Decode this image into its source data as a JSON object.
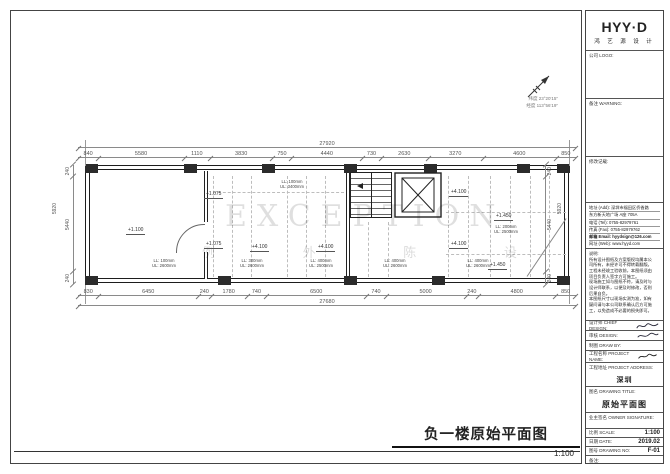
{
  "page": {
    "main_title": "负一楼原始平面图",
    "main_scale": "1:100"
  },
  "compass": {
    "line1": "纬度 23°20′15″",
    "line2": "经度 113°56′19″"
  },
  "watermark": {
    "en": "EXCEPTION",
    "cn": "例 外 陈 设"
  },
  "plan": {
    "levels": [
      {
        "text": "+1.100"
      },
      {
        "text": "+1.075"
      },
      {
        "text": "+1.075"
      },
      {
        "text": "+4.100"
      },
      {
        "text": "+4.100"
      },
      {
        "text": "+4.100"
      },
      {
        "text": "+1.450"
      },
      {
        "text": "+4.100"
      },
      {
        "text": "+1.450"
      }
    ],
    "beams": [
      {
        "l1": "LL: 100mm",
        "l2": "UL: 3400mm"
      },
      {
        "l1": "LL: 100mm",
        "l2": "UL: 2600mm"
      },
      {
        "l1": "LL: 300mm",
        "l2": "UL: 2600mm"
      },
      {
        "l1": "LL: 400mm",
        "l2": "UL: 2500mm"
      },
      {
        "l1": "LL: 400mm",
        "l2": "UL: 2600mm"
      },
      {
        "l1": "LL: 200mm",
        "l2": "UL: 2500mm"
      },
      {
        "l1": "LL: 400mm",
        "l2": "UL: 2600mm"
      }
    ],
    "dims": {
      "top_total": "27920",
      "top": [
        "840",
        "5580",
        "1110",
        "3830",
        "750",
        "4440",
        "730",
        "2630",
        "3270",
        "4600",
        "850"
      ],
      "bottom_total": "27680",
      "bottom": [
        "830",
        "6450",
        "240",
        "1780",
        "740",
        "6500",
        "740",
        "5000",
        "240",
        "4800",
        "850"
      ],
      "left_total": "5920",
      "left": [
        "240",
        "5440",
        "240"
      ],
      "right_total": "5920",
      "right": [
        "240",
        "5440",
        "240"
      ]
    }
  },
  "panel": {
    "logo": {
      "text": "HYY·D",
      "sub": "鸿 艺 源 设 计"
    },
    "company_logo_label": "公司 LOGO:",
    "warning_label": "备注 WARNING:",
    "revision_label": "修改记载:",
    "contact": {
      "addr1": "地址 (Add): 深圳市福田区侨香路",
      "addr2": "东方新天地广场 A座 705A",
      "tel": "电话 (Tel): 0755-82979761",
      "fax": "传真 (Fax): 0755-82979762",
      "email": "邮箱 Email: hyydsign@126.com",
      "web": "网址 (Web): www.hyyd.com"
    },
    "notes": "说明:\n所有设计图纸及方案版权均属本公\n司所有，未经许可不得转载翻版。\n工程未经竣工验收前，本图纸须由\n项目负责人签字方可施工。\n现场施工如与图纸不符，请及时与\n设计师联系，以便及时修改，否则\n后果自负。\n本图纸尺寸以现场实测为准，如有\n疑问请与本公司联系确认后方可施\n工，以免造成不必要的损失即可。",
    "fields": {
      "chief_label": "设计师 CHIEF DESIGN:",
      "review_label": "审核 DESIGN:",
      "drawby_label": "制图 DRAW BY:",
      "pname_label": "工程名称 PROJECT NAME:",
      "paddr_label": "工程地址 PROJECT ADDRESS:",
      "paddr_value": "深圳",
      "dtitle_label": "图名 DRAWING TITLE:",
      "dtitle_value": "原始平面图",
      "owner_label": "业主签名 OWNER SIGNATURE:",
      "scale_label": "比例 SCALE:",
      "scale_value": "1:100",
      "date_label": "日期 DATE:",
      "date_value": "2019.02",
      "no_label": "图号 DRAWING NO:",
      "no_value": "F-01",
      "note_label": "备注:"
    }
  }
}
